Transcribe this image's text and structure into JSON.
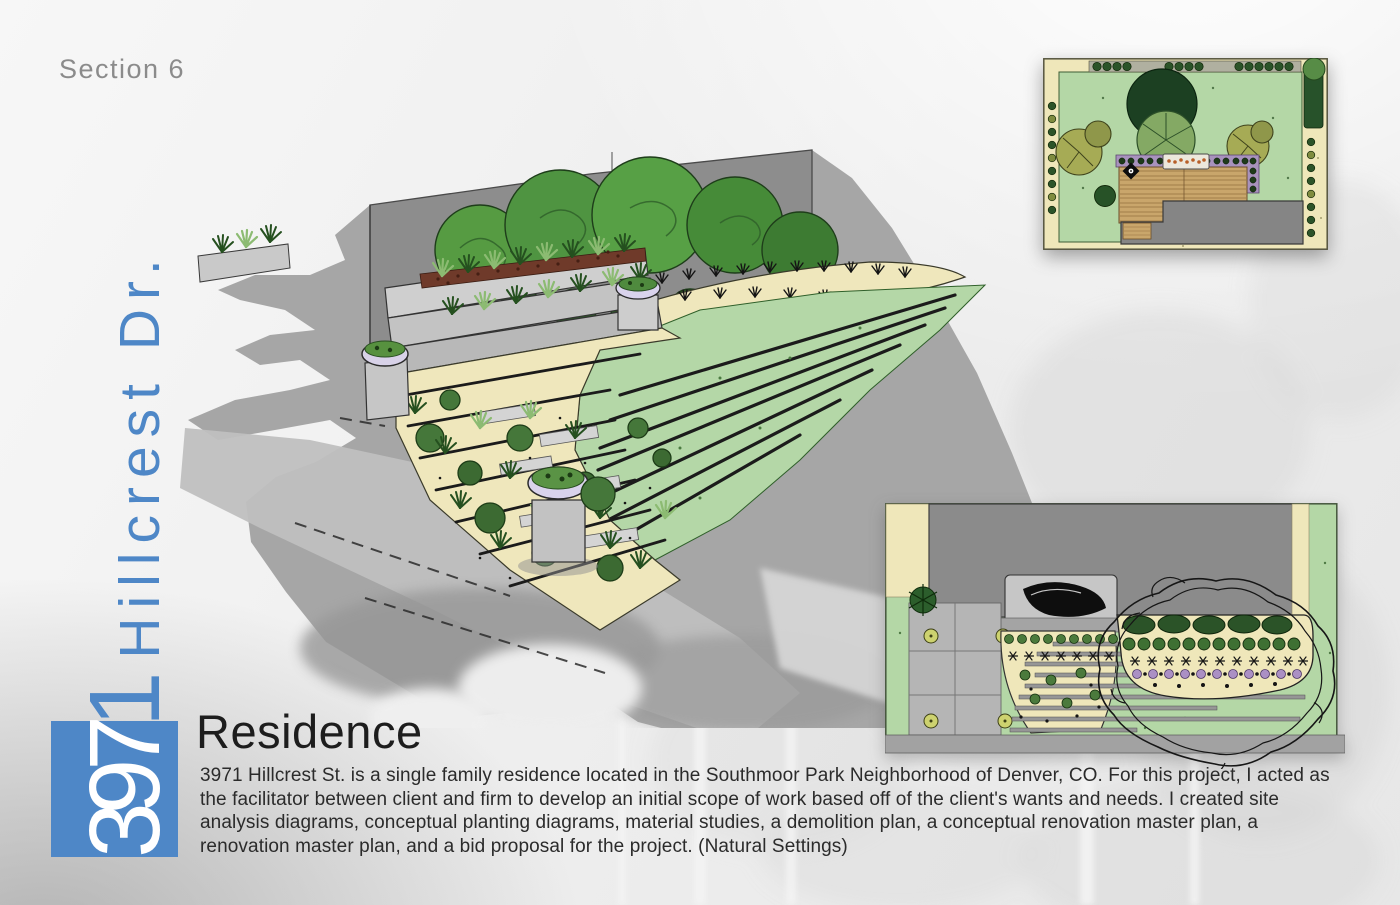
{
  "meta": {
    "section_label": "Section 6"
  },
  "sidebar": {
    "address_full": "3971 Hillcrest Dr.",
    "address_digits_in_box": "397",
    "address_digit_above_box": "1",
    "address_street": " Hillcrest Dr."
  },
  "article": {
    "title": "Residence",
    "body": "3971 Hillcrest St. is a single family residence located in the Southmoor Park Neighborhood of Denver, CO. For this project, I acted as the facilitator between client and firm to develop an initial scope of work based off of the client's wants and needs. I created site analysis diagrams, conceptual planting diagrams, material studies, a demolition plan, a conceptual renovation master plan, a renovation master plan, and a bid proposal for the project. (Natural Settings)"
  },
  "palette": {
    "accent_blue": "#4e87c7",
    "label_gray": "#8b8b8b",
    "text_dark": "#2b2b2b",
    "lawn_green": "#b4d7a6",
    "bed_cream": "#efe7ba",
    "wall_gray": "#8d8d8d",
    "shadow_gray": "#a6a6a6",
    "deck_tan": "#c9a66b",
    "edge_purple": "#a892bc"
  }
}
